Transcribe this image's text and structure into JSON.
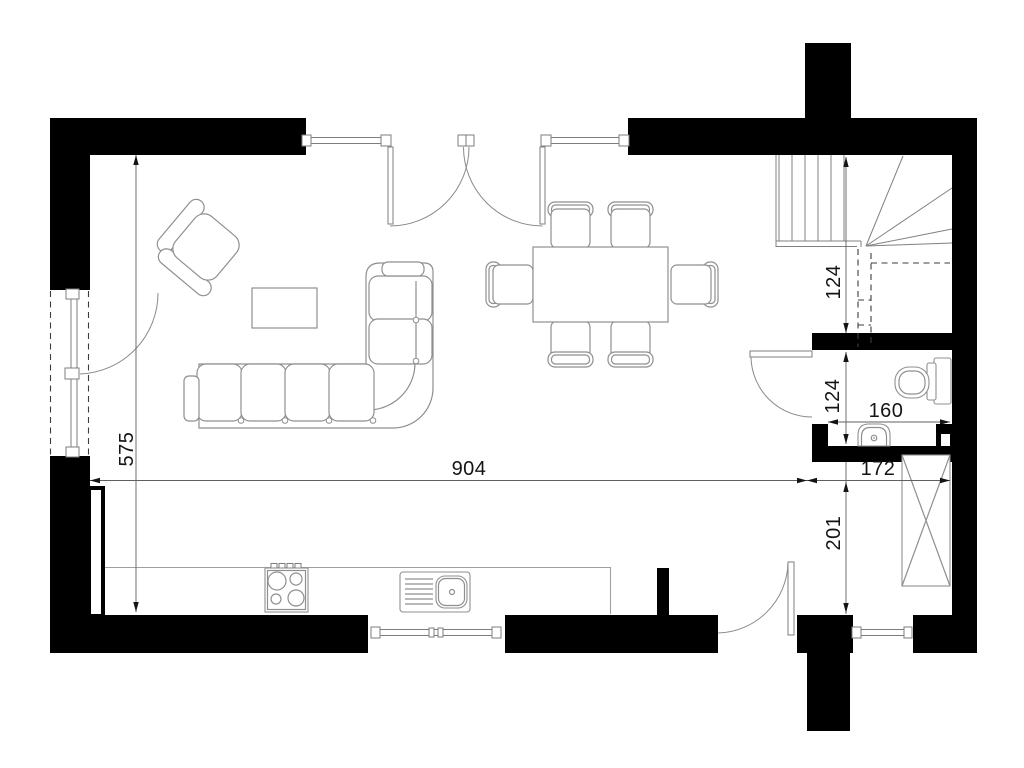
{
  "drawing": {
    "type": "architectural-floor-plan",
    "background": "#ffffff",
    "wall_color": "#000000",
    "furniture_line_color": "#8f8f8f",
    "dimension_text_color": "#141414"
  },
  "dims": {
    "living_width": "904",
    "living_depth": "575",
    "stair_bay_depth": "124",
    "wc_depth": "124",
    "wc_width": "160",
    "entry_width": "172",
    "entry_depth": "201"
  },
  "objects": {
    "icons": [
      "armchair-icon",
      "sofa-icon",
      "coffee-table-icon",
      "dining-table-icon",
      "dining-chair-icon",
      "cooktop-icon",
      "kitchen-sink-icon",
      "radiator-icon",
      "stair-icon",
      "toilet-icon",
      "washbasin-icon",
      "wardrobe-icon",
      "door-swing-icon",
      "window-icon"
    ]
  }
}
